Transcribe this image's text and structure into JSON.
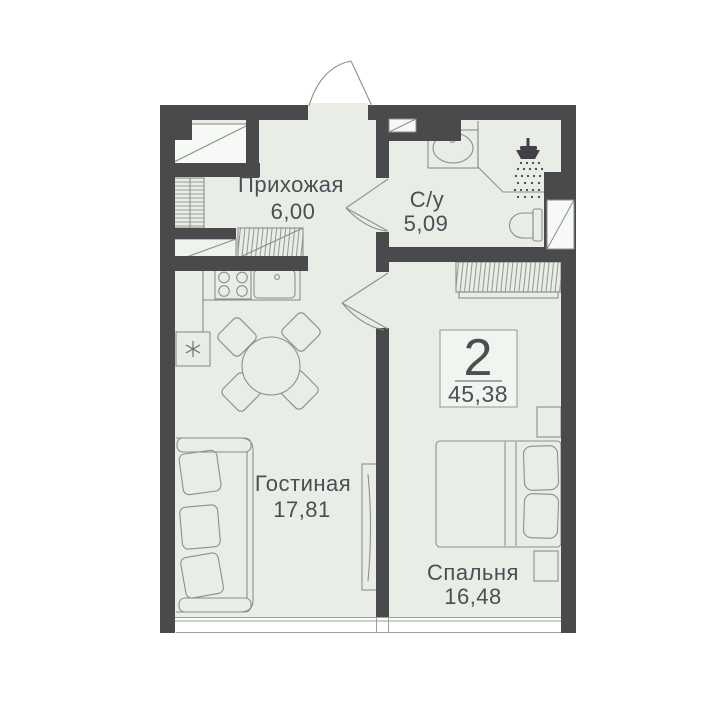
{
  "floor_plan": {
    "badge": {
      "room_count": "2",
      "total_area": "45,38"
    },
    "rooms": {
      "hallway": {
        "name": "Прихожая",
        "area": "6,00"
      },
      "bathroom": {
        "name": "С/у",
        "area": "5,09"
      },
      "living": {
        "name": "Гостиная",
        "area": "17,81"
      },
      "bedroom": {
        "name": "Спальня",
        "area": "16,48"
      }
    },
    "icons": {
      "shower": "shower-icon",
      "fridge": "snowflake-icon"
    },
    "colors": {
      "wall": "#4a4a4c",
      "floor": "#e8ede6",
      "furniture_outline": "#8a908a",
      "text": "#4c4e54",
      "background": "#ffffff"
    }
  }
}
